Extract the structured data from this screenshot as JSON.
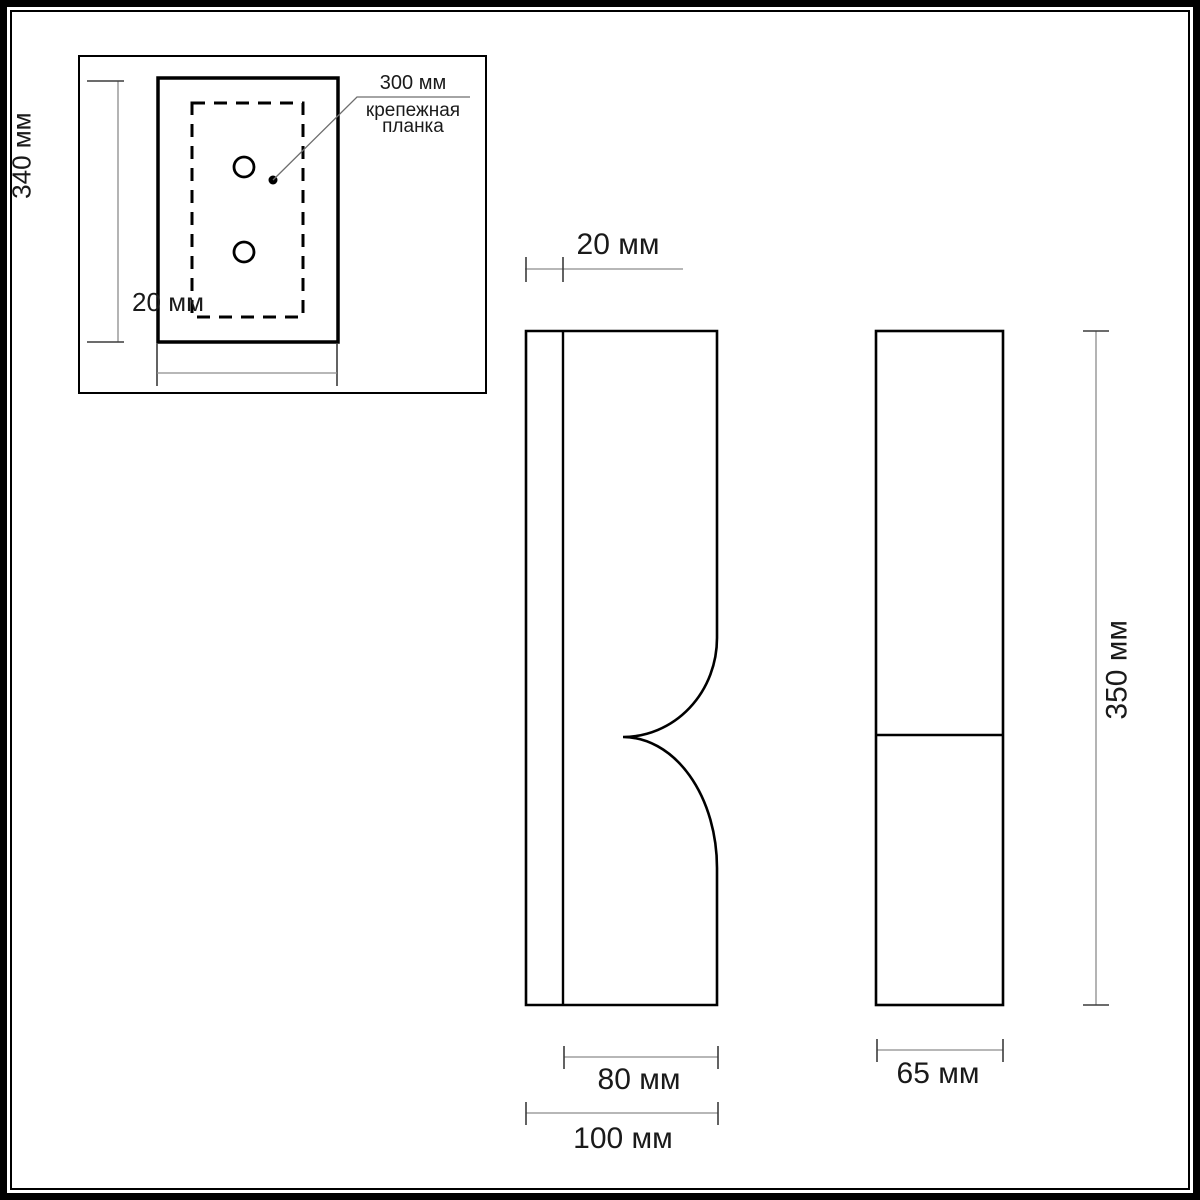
{
  "colors": {
    "line": "#000000",
    "dim_line": "#8c8c8c",
    "tick": "#3c3c3c",
    "text": "#1a1a1a",
    "background": "#ffffff"
  },
  "inset": {
    "height_label": "340 мм",
    "width_label": "20 мм",
    "callout": {
      "dimension": "300 мм",
      "name_line1": "крепежная",
      "name_line2": "планка"
    }
  },
  "front_view": {
    "depth_label": "20 мм",
    "inner_width_label": "80 мм",
    "total_width_label": "100 мм"
  },
  "side_view": {
    "width_label": "65 мм",
    "height_label": "350 мм"
  }
}
